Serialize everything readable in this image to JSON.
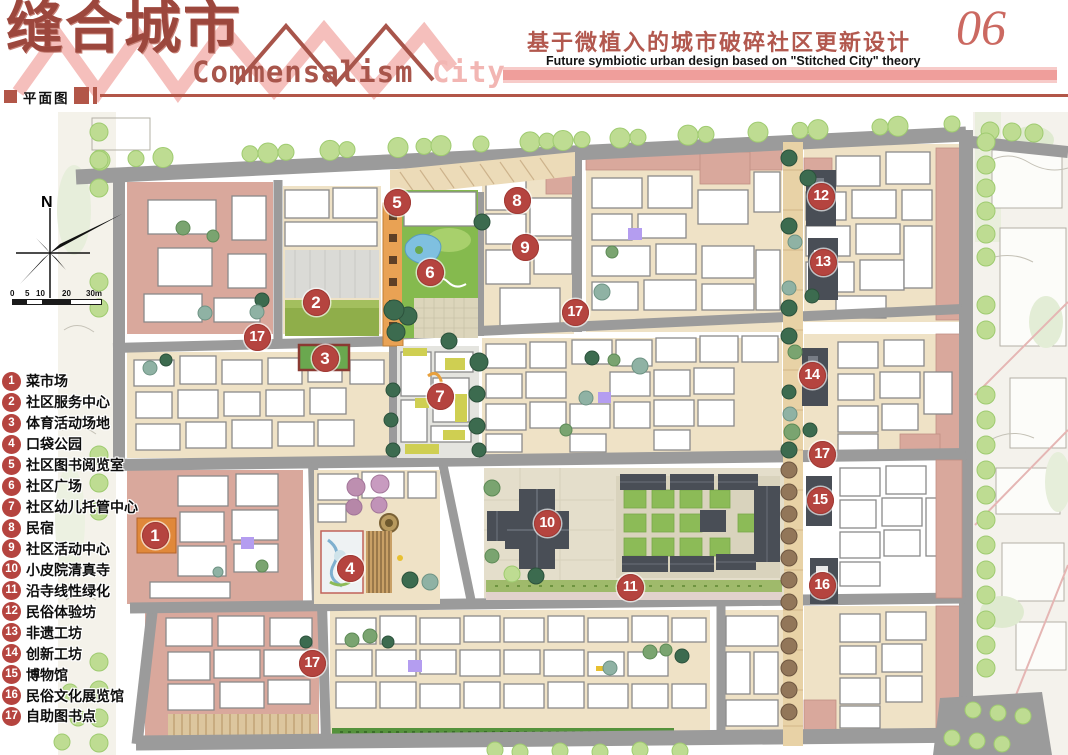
{
  "header": {
    "title_cn": "缝合城市",
    "title_en_word1": "Commensalism ",
    "title_en_word2": "City",
    "subtitle_cn": "基于微植入的城市破碎社区更新设计",
    "subtitle_en": "Future symbiotic urban design based on \"Stitched City\" theory",
    "page_number": "06",
    "section_label": "平面图"
  },
  "legend": {
    "items": [
      {
        "number": "1",
        "label": "菜市场"
      },
      {
        "number": "2",
        "label": "社区服务中心"
      },
      {
        "number": "3",
        "label": "体育活动场地"
      },
      {
        "number": "4",
        "label": "口袋公园"
      },
      {
        "number": "5",
        "label": "社区图书阅览室"
      },
      {
        "number": "6",
        "label": "社区广场"
      },
      {
        "number": "7",
        "label": "社区幼儿托管中心"
      },
      {
        "number": "8",
        "label": "民宿"
      },
      {
        "number": "9",
        "label": "社区活动中心"
      },
      {
        "number": "10",
        "label": "小皮院清真寺"
      },
      {
        "number": "11",
        "label": "沿寺线性绿化"
      },
      {
        "number": "12",
        "label": "民俗体验坊"
      },
      {
        "number": "13",
        "label": "非遗工坊"
      },
      {
        "number": "14",
        "label": "创新工坊"
      },
      {
        "number": "15",
        "label": "博物馆"
      },
      {
        "number": "16",
        "label": "民俗文化展览馆"
      },
      {
        "number": "17",
        "label": "自助图书点"
      }
    ]
  },
  "map": {
    "north_label": "N",
    "scale_ticks": [
      "0",
      "5",
      "10",
      "20",
      "30m"
    ],
    "markers": [
      {
        "num": "1",
        "x": 155,
        "y": 535,
        "label": "菜市场"
      },
      {
        "num": "2",
        "x": 316,
        "y": 302,
        "label": "社区服务中心"
      },
      {
        "num": "3",
        "x": 325,
        "y": 358,
        "label": "体育活动场地"
      },
      {
        "num": "4",
        "x": 350,
        "y": 568,
        "label": "口袋公园"
      },
      {
        "num": "5",
        "x": 397,
        "y": 202,
        "label": "社区图书阅览室"
      },
      {
        "num": "6",
        "x": 430,
        "y": 272,
        "label": "社区广场"
      },
      {
        "num": "7",
        "x": 440,
        "y": 396,
        "label": "社区幼儿托管中心"
      },
      {
        "num": "8",
        "x": 517,
        "y": 200,
        "label": "民宿"
      },
      {
        "num": "9",
        "x": 525,
        "y": 247,
        "label": "社区活动中心"
      },
      {
        "num": "10",
        "x": 547,
        "y": 523,
        "label": "小皮院清真寺"
      },
      {
        "num": "11",
        "x": 630,
        "y": 587,
        "label": "沿寺线性绿化"
      },
      {
        "num": "12",
        "x": 821,
        "y": 196,
        "label": "民俗体验坊"
      },
      {
        "num": "13",
        "x": 823,
        "y": 262,
        "label": "非遗工坊"
      },
      {
        "num": "14",
        "x": 812,
        "y": 375,
        "label": "创新工坊"
      },
      {
        "num": "15",
        "x": 820,
        "y": 500,
        "label": "博物馆"
      },
      {
        "num": "16",
        "x": 822,
        "y": 585,
        "label": "民俗文化展览馆"
      },
      {
        "num": "17",
        "x": 257,
        "y": 337,
        "label": "自助图书点"
      },
      {
        "num": "17",
        "x": 575,
        "y": 312,
        "label": "自助图书点"
      },
      {
        "num": "17",
        "x": 822,
        "y": 454,
        "label": "自助图书点"
      },
      {
        "num": "17",
        "x": 312,
        "y": 663,
        "label": "自助图书点"
      }
    ]
  },
  "colors": {
    "accent_red": "#b25648",
    "title_red": "#9c473d",
    "zigzag_pink": "#f5bfbc",
    "bar_pink": "#ef9e9b",
    "marker_red": "#b5443f",
    "block_pink": "#d9a89c",
    "road_gray": "#9b9b9b",
    "lane_beige": "#efe2c6",
    "park_green": "#85ba4e",
    "street_tree_green": "#bedc92",
    "market_orange": "#e9a254",
    "roof_dark": "#494e56",
    "accent_purple": "#b49df0"
  }
}
